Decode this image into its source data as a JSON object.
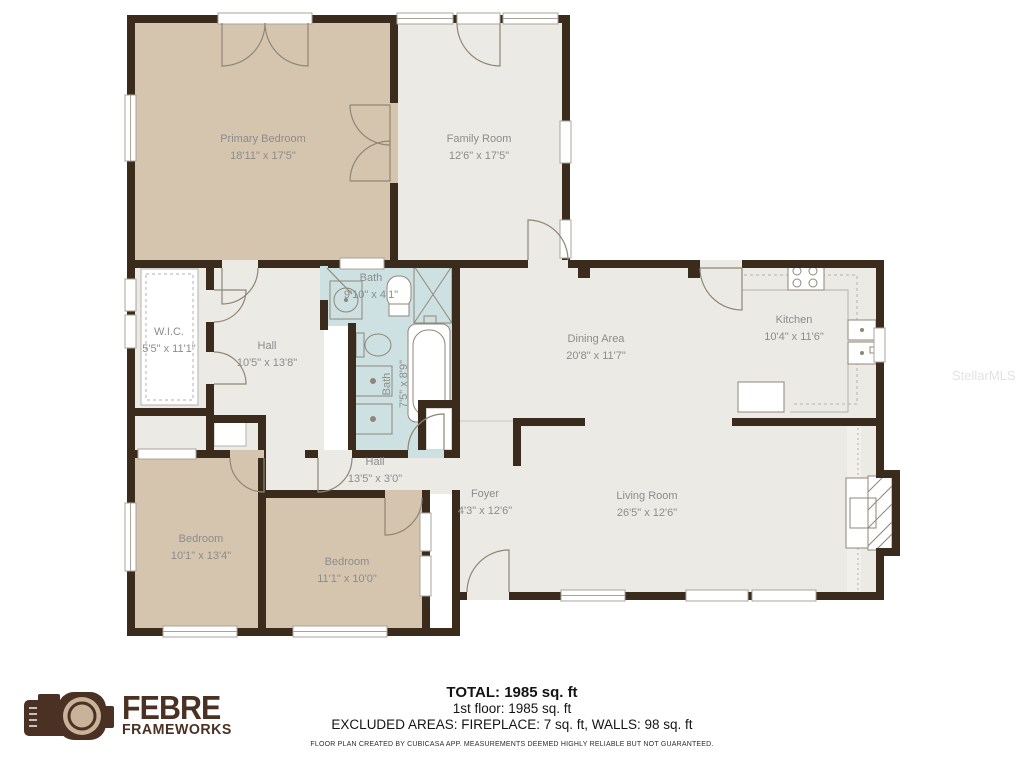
{
  "watermark": {
    "text": "StellarMLS"
  },
  "logo": {
    "brand": "FEBRE",
    "sub": "FRAMEWORKS"
  },
  "summary": {
    "total": "TOTAL: 1985 sq. ft",
    "first_floor": "1st floor: 1985 sq. ft",
    "excluded": "EXCLUDED AREAS: FIREPLACE: 7 sq. ft, WALLS: 98 sq. ft",
    "disclaimer": "FLOOR PLAN CREATED BY CUBICASA APP. MEASUREMENTS DEEMED HIGHLY RELIABLE BUT NOT GUARANTEED."
  },
  "rooms": [
    {
      "id": "primary-bedroom",
      "name": "Primary Bedroom",
      "dims": "18'11\" x 17'5\""
    },
    {
      "id": "family-room",
      "name": "Family Room",
      "dims": "12'6\" x 17'5\""
    },
    {
      "id": "bath-upper",
      "name": "Bath",
      "dims": "9'10\" x 4'1\""
    },
    {
      "id": "wic",
      "name": "W.I.C.",
      "dims": "5'5\" x 11'1\""
    },
    {
      "id": "hall-upper",
      "name": "Hall",
      "dims": "10'5\" x 13'8\""
    },
    {
      "id": "bath-lower",
      "name": "Bath",
      "dims": "7'5\" x 8'9\""
    },
    {
      "id": "dining-area",
      "name": "Dining Area",
      "dims": "20'8\" x 11'7\""
    },
    {
      "id": "kitchen",
      "name": "Kitchen",
      "dims": "10'4\" x 11'6\""
    },
    {
      "id": "hall-lower",
      "name": "Hall",
      "dims": "13'5\" x 3'0\""
    },
    {
      "id": "foyer",
      "name": "Foyer",
      "dims": "4'3\" x 12'6\""
    },
    {
      "id": "living-room",
      "name": "Living Room",
      "dims": "26'5\" x 12'6\""
    },
    {
      "id": "bedroom-left",
      "name": "Bedroom",
      "dims": "10'1\" x 13'4\""
    },
    {
      "id": "bedroom-right",
      "name": "Bedroom",
      "dims": "11'1\" x 10'0\""
    }
  ],
  "colors": {
    "wall": "#3b2b1c",
    "room_tan": "#d5c5af",
    "room_gray": "#eceae5",
    "room_bath": "#cde1e2",
    "label_text": "#8c8c8c",
    "logo_brown": "#4a3123"
  }
}
